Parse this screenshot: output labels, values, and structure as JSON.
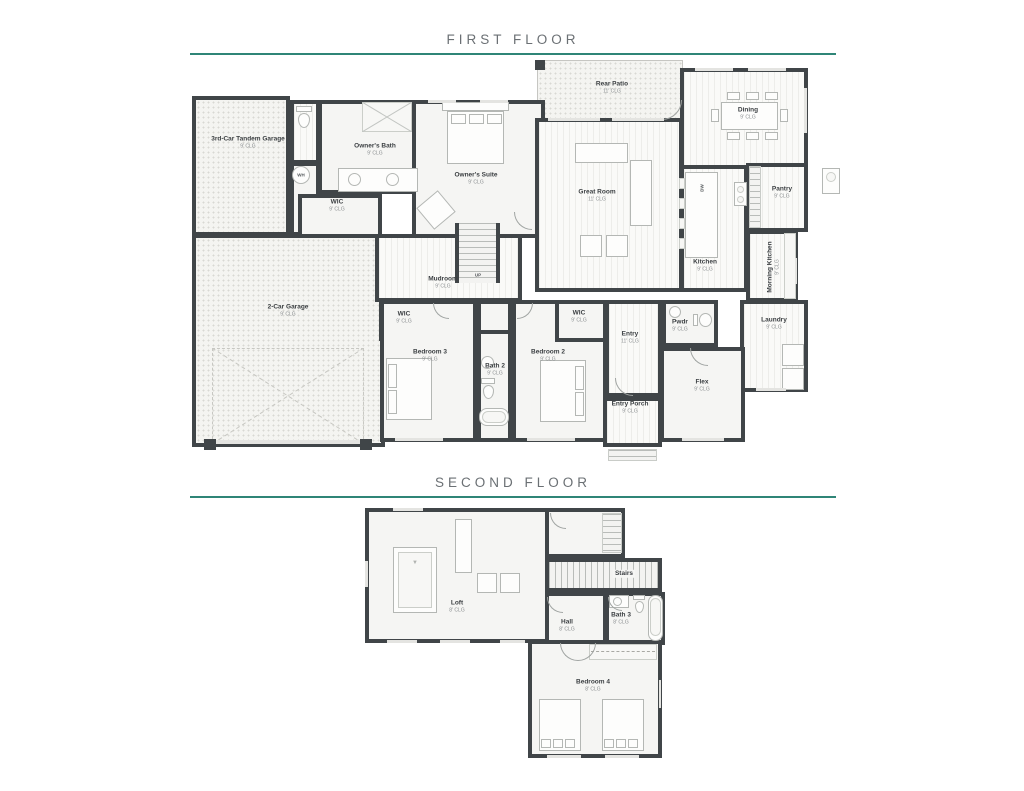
{
  "accent_color": "#2f8577",
  "wall_color": "#404548",
  "floors": {
    "first": {
      "title": "FIRST FLOOR",
      "rooms": {
        "garage3": {
          "name": "3rd-Car Tandem Garage",
          "clg": "9' CLG"
        },
        "garage2": {
          "name": "2-Car Garage",
          "clg": "9' CLG"
        },
        "owners_bath": {
          "name": "Owner's Bath",
          "clg": "9' CLG"
        },
        "wic_owner": {
          "name": "WIC",
          "clg": "9' CLG"
        },
        "owners_suite": {
          "name": "Owner's Suite",
          "clg": "9' CLG"
        },
        "rear_patio": {
          "name": "Rear Patio",
          "clg": "11' CLG"
        },
        "great_room": {
          "name": "Great Room",
          "clg": "11' CLG"
        },
        "dining": {
          "name": "Dining",
          "clg": "9' CLG"
        },
        "kitchen": {
          "name": "Kitchen",
          "clg": "9' CLG"
        },
        "pantry": {
          "name": "Pantry",
          "clg": "9' CLG"
        },
        "morning_kitchen": {
          "name": "Morning Kitchen",
          "clg": "9' CLG"
        },
        "laundry": {
          "name": "Laundry",
          "clg": "9' CLG"
        },
        "mudroom": {
          "name": "Mudroom",
          "clg": "9' CLG"
        },
        "bedroom3": {
          "name": "Bedroom 3",
          "clg": "9' CLG"
        },
        "wic3": {
          "name": "WIC",
          "clg": "9' CLG"
        },
        "bath2": {
          "name": "Bath 2",
          "clg": "9' CLG"
        },
        "bedroom2": {
          "name": "Bedroom 2",
          "clg": "9' CLG"
        },
        "wic2": {
          "name": "WIC",
          "clg": "9' CLG"
        },
        "entry": {
          "name": "Entry",
          "clg": "11' CLG"
        },
        "pwdr": {
          "name": "Pwdr",
          "clg": "9' CLG"
        },
        "flex": {
          "name": "Flex",
          "clg": "9' CLG"
        },
        "entry_porch": {
          "name": "Entry Porch",
          "clg": "9' CLG"
        }
      }
    },
    "second": {
      "title": "SECOND FLOOR",
      "rooms": {
        "loft": {
          "name": "Loft",
          "clg": "8' CLG"
        },
        "stairs": {
          "name": "Stairs"
        },
        "hall": {
          "name": "Hall",
          "clg": "8' CLG"
        },
        "bath3": {
          "name": "Bath 3",
          "clg": "8' CLG"
        },
        "bedroom4": {
          "name": "Bedroom 4",
          "clg": "8' CLG"
        }
      }
    }
  },
  "annotations": {
    "water_heater": "WH",
    "stairs_up": "UP",
    "dishwasher": "DW"
  }
}
